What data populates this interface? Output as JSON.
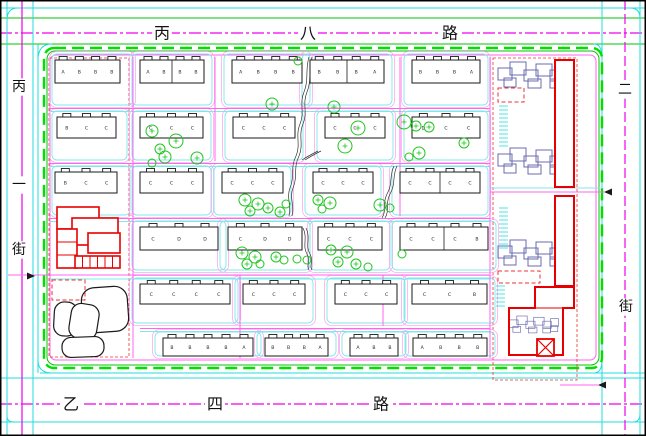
{
  "drawing": {
    "type": "residential-district-site-plan",
    "colors": {
      "cyan": "#21dede",
      "cyan_light": "#7de8e8",
      "magenta": "#ee00ee",
      "pink": "#ff66f0",
      "pink_light": "#ffa8f2",
      "green": "#00c400",
      "green_bright": "#00e000",
      "red": "#e80000",
      "red_dash": "#f03030",
      "navy": "#6b6bb0",
      "tree": "#1fc41f",
      "ink": "#1a1a1a"
    },
    "roads": {
      "top": {
        "name": "丙八路"
      },
      "bottom": {
        "name": "乙四路"
      },
      "left": {
        "name": "丙一街"
      },
      "right": {
        "name": "二街"
      }
    },
    "labels": [
      {
        "t": "丙",
        "x": 162,
        "y": 33,
        "s": 16,
        "road": "top"
      },
      {
        "t": "八",
        "x": 308,
        "y": 33,
        "s": 16,
        "road": "top"
      },
      {
        "t": "路",
        "x": 450,
        "y": 33,
        "s": 16,
        "road": "top"
      },
      {
        "t": "乙",
        "x": 71,
        "y": 404,
        "s": 16,
        "road": "bottom"
      },
      {
        "t": "四",
        "x": 215,
        "y": 404,
        "s": 16,
        "road": "bottom"
      },
      {
        "t": "路",
        "x": 381,
        "y": 404,
        "s": 16,
        "road": "bottom"
      },
      {
        "t": "丙",
        "x": 19,
        "y": 87,
        "s": 14,
        "road": "left"
      },
      {
        "t": "一",
        "x": 19,
        "y": 185,
        "s": 14,
        "road": "left"
      },
      {
        "t": "街",
        "x": 19,
        "y": 250,
        "s": 14,
        "road": "left"
      },
      {
        "t": "二",
        "x": 625,
        "y": 90,
        "s": 14,
        "road": "right"
      },
      {
        "t": "街",
        "x": 626,
        "y": 307,
        "s": 14,
        "road": "right"
      }
    ],
    "road_lines": {
      "h": [
        {
          "y": 8,
          "x1": 0,
          "x2": 646,
          "c": "cyan"
        },
        {
          "y": 18,
          "x1": 0,
          "x2": 646,
          "c": "green"
        },
        {
          "y": 33,
          "x1": 0,
          "x2": 646,
          "c": "magenta",
          "dash": "12 3 3 3"
        },
        {
          "y": 44,
          "x1": 0,
          "x2": 646,
          "c": "green"
        },
        {
          "y": 373,
          "x1": 40,
          "x2": 646,
          "c": "cyan"
        },
        {
          "y": 378,
          "x1": 0,
          "x2": 646,
          "c": "cyan"
        },
        {
          "y": 404,
          "x1": 0,
          "x2": 646,
          "c": "magenta",
          "dash": "12 3 3 3"
        },
        {
          "y": 422,
          "x1": 0,
          "x2": 646,
          "c": "cyan"
        }
      ],
      "v": [
        {
          "x": 7,
          "y1": 0,
          "y2": 436,
          "c": "cyan"
        },
        {
          "x": 22,
          "y1": 0,
          "y2": 436,
          "c": "magenta"
        },
        {
          "x": 33,
          "y1": 0,
          "y2": 436,
          "c": "cyan"
        },
        {
          "x": 38,
          "y1": 44,
          "y2": 373,
          "c": "cyan"
        },
        {
          "x": 602,
          "y1": 0,
          "y2": 436,
          "c": "cyan"
        },
        {
          "x": 625,
          "y1": 0,
          "y2": 436,
          "c": "magenta",
          "dash": "10 4"
        },
        {
          "x": 640,
          "y1": 0,
          "y2": 436,
          "c": "cyan"
        }
      ]
    },
    "block_boundary": {
      "pink": {
        "x": 50,
        "y": 55,
        "w": 546,
        "h": 305,
        "rx": 6
      },
      "green": {
        "x": 47,
        "y": 51,
        "w": 552,
        "h": 314,
        "rx": 8
      },
      "green_dash": {
        "x": 44,
        "y": 48,
        "w": 558,
        "h": 320,
        "rx": 10
      }
    },
    "internal_roads": {
      "h_pink": [
        {
          "y": 108.5,
          "x1": 50,
          "x2": 490
        },
        {
          "y": 163.5,
          "x1": 50,
          "x2": 490
        },
        {
          "y": 218.5,
          "x1": 50,
          "x2": 490
        },
        {
          "y": 275,
          "x1": 8,
          "x2": 490
        },
        {
          "y": 328.5,
          "x1": 140,
          "x2": 490
        },
        {
          "y": 192,
          "x1": 490,
          "x2": 604
        },
        {
          "y": 385,
          "x1": 560,
          "x2": 598
        }
      ],
      "h_cyan": [
        {
          "y": 111.5,
          "x1": 50,
          "x2": 490
        },
        {
          "y": 166.5,
          "x1": 50,
          "x2": 490
        },
        {
          "y": 221.5,
          "x1": 50,
          "x2": 490
        },
        {
          "y": 279,
          "x1": 50,
          "x2": 490
        },
        {
          "y": 331.5,
          "x1": 140,
          "x2": 490
        },
        {
          "y": 188,
          "x1": 490,
          "x2": 600
        }
      ],
      "v_pink": [
        {
          "x": 133,
          "y1": 57,
          "y2": 358
        },
        {
          "x": 215,
          "y1": 57,
          "y2": 161
        },
        {
          "x": 400,
          "y1": 57,
          "y2": 216
        },
        {
          "x": 490,
          "y1": 57,
          "y2": 358
        },
        {
          "x": 240,
          "y1": 275,
          "y2": 358
        },
        {
          "x": 383,
          "y1": 275,
          "y2": 326
        }
      ]
    },
    "arrows": [
      {
        "points": "35,276 27,272.5 27,279.5"
      },
      {
        "points": "604,192 612,188.5 612,195.5"
      },
      {
        "points": "598,385 606,381.5 606,388.5"
      }
    ],
    "band_bottom": [
      105,
      160,
      215,
      270,
      323,
      356
    ],
    "building_rows": [
      [
        {
          "x": 55,
          "y": 60,
          "w": 65,
          "h": 23,
          "u": [
            "A",
            "B",
            "B",
            "B"
          ]
        },
        {
          "x": 140,
          "y": 60,
          "w": 64,
          "h": 23,
          "u": [
            "A",
            "B",
            "B",
            "B"
          ],
          "split": 1
        },
        {
          "x": 232,
          "y": 60,
          "w": 70,
          "h": 23,
          "u": [
            "A",
            "B",
            "B",
            "B"
          ]
        },
        {
          "x": 310,
          "y": 60,
          "w": 74,
          "h": 23,
          "u": [
            "B",
            "B",
            "B",
            "A"
          ],
          "split": 1
        },
        {
          "x": 412,
          "y": 60,
          "w": 68,
          "h": 23,
          "u": [
            "B",
            "B",
            "B",
            "A"
          ]
        }
      ],
      [
        {
          "x": 57,
          "y": 117,
          "w": 59,
          "h": 21,
          "u": [
            "B",
            "C",
            "C"
          ]
        },
        {
          "x": 140,
          "y": 117,
          "w": 63,
          "h": 21,
          "u": [
            "C",
            "C",
            "C"
          ]
        },
        {
          "x": 233,
          "y": 117,
          "w": 62,
          "h": 21,
          "u": [
            "C",
            "C",
            "C"
          ]
        },
        {
          "x": 325,
          "y": 117,
          "w": 60,
          "h": 21,
          "u": [
            "C",
            "C",
            "C"
          ]
        },
        {
          "x": 412,
          "y": 117,
          "w": 68,
          "h": 21,
          "u": [
            "D",
            "C",
            "C"
          ]
        }
      ],
      [
        {
          "x": 55,
          "y": 172,
          "w": 62,
          "h": 21,
          "u": [
            "B",
            "C",
            "C"
          ]
        },
        {
          "x": 140,
          "y": 172,
          "w": 63,
          "h": 21,
          "u": [
            "C",
            "C",
            "C"
          ]
        },
        {
          "x": 222,
          "y": 172,
          "w": 61,
          "h": 21,
          "u": [
            "C",
            "C",
            "C"
          ]
        },
        {
          "x": 313,
          "y": 172,
          "w": 60,
          "h": 21,
          "u": [
            "C",
            "C",
            "C"
          ]
        },
        {
          "x": 400,
          "y": 172,
          "w": 80,
          "h": 21,
          "u": [
            "C",
            "C",
            "C",
            "C"
          ],
          "split": 1
        }
      ],
      [
        {
          "x": 140,
          "y": 227,
          "w": 78,
          "h": 23,
          "u": [
            "C",
            "D",
            "D"
          ]
        },
        {
          "x": 228,
          "y": 227,
          "w": 74,
          "h": 23,
          "u": [
            "C",
            "D",
            "D"
          ]
        },
        {
          "x": 318,
          "y": 227,
          "w": 64,
          "h": 23,
          "u": [
            "C",
            "C",
            "C"
          ]
        },
        {
          "x": 400,
          "y": 227,
          "w": 88,
          "h": 23,
          "u": [
            "C",
            "C",
            "C",
            "B"
          ],
          "split": 1
        }
      ],
      [
        {
          "x": 140,
          "y": 284,
          "w": 90,
          "h": 20,
          "u": [
            "C",
            "C",
            "C",
            "C"
          ]
        },
        {
          "x": 243,
          "y": 284,
          "w": 62,
          "h": 20,
          "u": [
            "C",
            "C",
            "C"
          ]
        },
        {
          "x": 335,
          "y": 284,
          "w": 62,
          "h": 20,
          "u": [
            "C",
            "C",
            "C"
          ]
        },
        {
          "x": 412,
          "y": 284,
          "w": 75,
          "h": 20,
          "u": [
            "C",
            "C",
            "B"
          ]
        }
      ],
      [
        {
          "x": 163,
          "y": 338,
          "w": 90,
          "h": 18,
          "u": [
            "B",
            "B",
            "B",
            "B",
            "A"
          ]
        },
        {
          "x": 265,
          "y": 338,
          "w": 63,
          "h": 18,
          "u": [
            "B",
            "B",
            "B",
            "A"
          ]
        },
        {
          "x": 350,
          "y": 338,
          "w": 48,
          "h": 18,
          "u": [
            "A",
            "B",
            "B"
          ]
        },
        {
          "x": 413,
          "y": 338,
          "w": 74,
          "h": 18,
          "u": [
            "A",
            "B",
            "B",
            "B"
          ]
        }
      ]
    ],
    "trees": [
      [
        298,
        61,
        4
      ],
      [
        272,
        104,
        6
      ],
      [
        334,
        107,
        6
      ],
      [
        358,
        128,
        7
      ],
      [
        345,
        146,
        7
      ],
      [
        404,
        122,
        7
      ],
      [
        416,
        126,
        5
      ],
      [
        429,
        127,
        5
      ],
      [
        419,
        153,
        6
      ],
      [
        464,
        143,
        5
      ],
      [
        409,
        157,
        4
      ],
      [
        152,
        131,
        6
      ],
      [
        176,
        141,
        7
      ],
      [
        160,
        149,
        5
      ],
      [
        165,
        157,
        6
      ],
      [
        197,
        158,
        6
      ],
      [
        152,
        163,
        4
      ],
      [
        245,
        200,
        6
      ],
      [
        258,
        204,
        6
      ],
      [
        250,
        211,
        5
      ],
      [
        268,
        208,
        5
      ],
      [
        280,
        212,
        5
      ],
      [
        286,
        204,
        4
      ],
      [
        318,
        200,
        5
      ],
      [
        330,
        203,
        6
      ],
      [
        322,
        209,
        4
      ],
      [
        380,
        205,
        6
      ],
      [
        390,
        208,
        4
      ],
      [
        242,
        253,
        6
      ],
      [
        255,
        257,
        6
      ],
      [
        247,
        264,
        5
      ],
      [
        260,
        264,
        4
      ],
      [
        276,
        257,
        5
      ],
      [
        284,
        260,
        4
      ],
      [
        297,
        259,
        4
      ],
      [
        307,
        260,
        4
      ],
      [
        331,
        250,
        5
      ],
      [
        347,
        252,
        6
      ],
      [
        338,
        262,
        5
      ],
      [
        356,
        264,
        5
      ],
      [
        368,
        267,
        4
      ],
      [
        402,
        254,
        4
      ]
    ],
    "streams": [
      "M309,57 C305,70 309,80 304,92 C299,104 305,112 300,124 C295,136 301,144 296,156 C290,168 295,176 290,188 C286,198 292,206 289,216",
      "M303,228 C308,238 302,246 307,254 C311,262 306,266 309,270",
      "M302,160 C308,156 312,154 318,151",
      "M394,166 C389,176 393,184 387,194 C382,204 387,210 382,218"
    ],
    "school": {
      "rects": [
        [
          57,
          207,
          42,
          22
        ],
        [
          72,
          218,
          46,
          27
        ],
        [
          88,
          233,
          32,
          20
        ],
        [
          57,
          229,
          20,
          39
        ],
        [
          75,
          256,
          45,
          12
        ]
      ],
      "strip_dividers_y": [
        242,
        255
      ],
      "stall_dividers_x": [
        82.5,
        90,
        97.5,
        105,
        112.5
      ]
    },
    "blobs": [
      {
        "x": 82,
        "y": 287,
        "w": 46,
        "h": 45,
        "rx": 13,
        "rot": -4
      },
      {
        "x": 54,
        "y": 302,
        "w": 23,
        "h": 34,
        "rx": 10,
        "rot": 3
      },
      {
        "x": 70,
        "y": 304,
        "w": 28,
        "h": 35,
        "rx": 10,
        "rot": 9
      },
      {
        "x": 62,
        "y": 337,
        "w": 42,
        "h": 20,
        "rx": 9,
        "rot": -2
      }
    ],
    "red_dashed_rects": [
      [
        52,
        280,
        33,
        20
      ],
      [
        498,
        88,
        26,
        14
      ],
      [
        498,
        271,
        42,
        12
      ]
    ],
    "red_dashed_boundaries": [
      [
        49,
        58,
        80,
        299
      ],
      [
        493,
        58,
        84,
        322
      ]
    ],
    "right_wing": {
      "cluster_rects": [
        [
          0,
          6,
          14,
          12
        ],
        [
          12,
          0,
          16,
          13
        ],
        [
          26,
          8,
          14,
          11
        ],
        [
          38,
          2,
          16,
          12
        ],
        [
          52,
          8,
          13,
          11
        ],
        [
          6,
          16,
          12,
          9
        ],
        [
          30,
          17,
          13,
          9
        ],
        [
          52,
          17,
          12,
          9
        ],
        [
          64,
          4,
          12,
          12
        ],
        [
          64,
          15,
          11,
          9
        ]
      ],
      "cluster_positions": [
        [
          498,
          62
        ],
        [
          498,
          148
        ],
        [
          498,
          240
        ]
      ],
      "small_cluster": {
        "x": 509,
        "y": 316,
        "scale": 0.65
      },
      "red_rects": [
        [
          555,
          60,
          19,
          127
        ],
        [
          555,
          196,
          19,
          90
        ]
      ],
      "red_complex_path": "M535,287 L574,287 L574,308 L563,308 L563,355 L509,355 L509,308 L535,308 Z",
      "red_complex_inner": "M509,308 L563,308",
      "x_box": {
        "x": 537,
        "y": 339,
        "w": 17,
        "h": 17
      },
      "hatches": [
        [
          499,
          106,
          9,
          42
        ],
        [
          499,
          208,
          9,
          42
        ],
        [
          496,
          286,
          9,
          22
        ]
      ]
    },
    "corner_arcs": [
      "M38,60 Q38,44 52,44",
      "M594,44 Q602,44 602,58",
      "M38,360 Q38,373 52,373",
      "M594,373 Q602,373 602,360",
      "M7,20 Q7,8 18,8",
      "M630,8 Q640,8 640,18",
      "M7,416 Q7,422 14,422",
      "M633,422 Q640,422 640,414"
    ]
  }
}
